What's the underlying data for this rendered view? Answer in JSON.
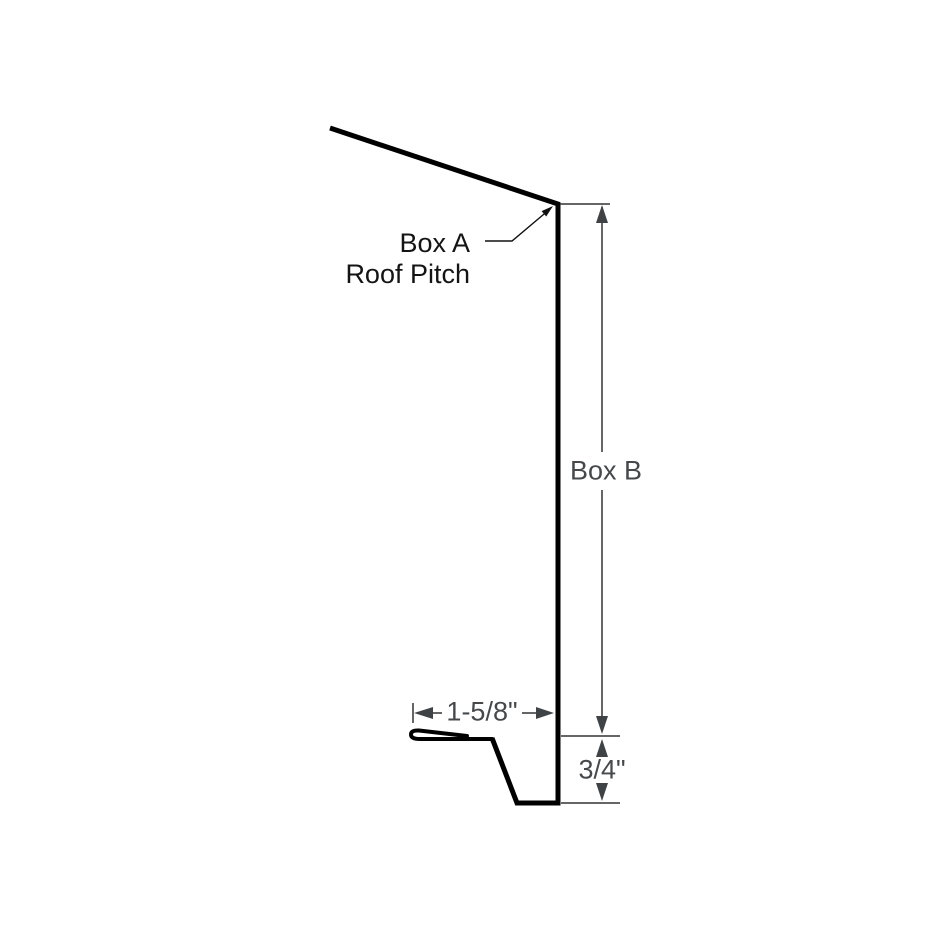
{
  "annotations": {
    "box_a": {
      "line1": "Box A",
      "line2": "Roof Pitch"
    },
    "box_b": "Box B",
    "width_dim": "1-5/8\"",
    "kick_dim": "3/4\""
  },
  "colors": {
    "background": "#ffffff",
    "profile-stroke": "#000000",
    "dim-line": "#333333",
    "arrow-fill": "#404346",
    "dim-text": "#46494c",
    "label-text": "#141414",
    "leader-stroke": "#111111"
  }
}
